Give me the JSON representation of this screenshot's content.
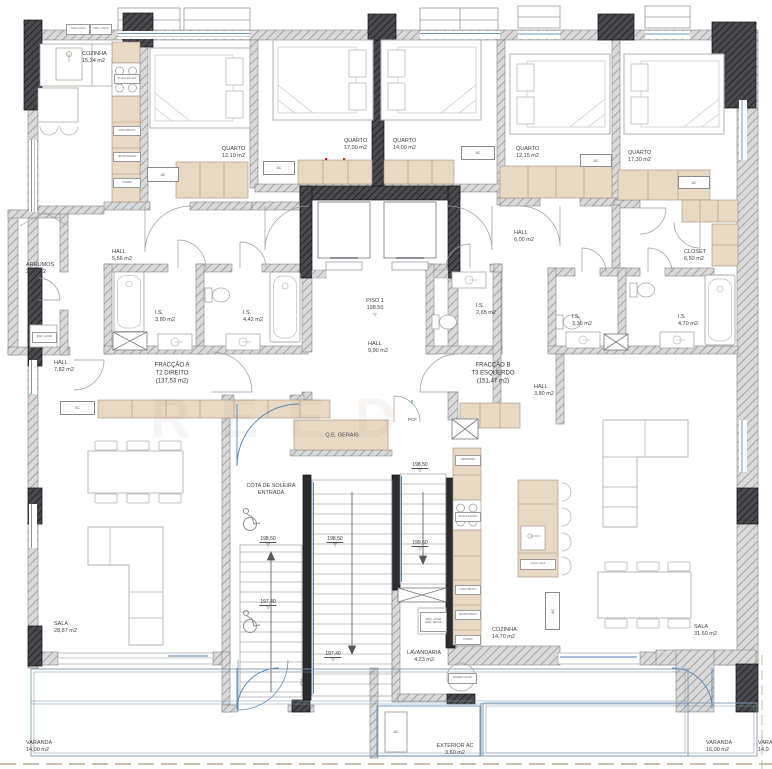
{
  "watermark": "REED",
  "ac_label": "AC",
  "colors": {
    "wall_fill": "#d9d9d9",
    "wall_line": "#8f8f94",
    "dark_fill": "#46464a",
    "tan": "#e8d9c4",
    "tan_border": "#a5937d",
    "blue": "#4f86b5",
    "furniture_line": "#b2b2ba",
    "text": "#3e3e47"
  },
  "rooms": {
    "cozinha_a": {
      "name": "COZINHA",
      "area": "15,34 m2"
    },
    "quarto_a1": {
      "name": "QUARTO",
      "area": "12,10 m2"
    },
    "quarto_a2": {
      "name": "QUARTO",
      "area": "17,00 m2"
    },
    "quarto_b1": {
      "name": "QUARTO",
      "area": "14,00 m2"
    },
    "quarto_b2": {
      "name": "QUARTO",
      "area": "12,15 m2"
    },
    "quarto_b3": {
      "name": "QUARTO",
      "area": "17,30 m2"
    },
    "hall_a1": {
      "name": "HALL",
      "area": "5,56 m2"
    },
    "arrumos": {
      "name": "ARRUMOS",
      "area": "2,00 m2"
    },
    "is_a1": {
      "name": "I.S.",
      "area": "3,60 m2"
    },
    "is_a2": {
      "name": "I.S.",
      "area": "4,42 m2"
    },
    "hall_a2": {
      "name": "HALL",
      "area": "7,82 m2"
    },
    "sala_a": {
      "name": "SALA",
      "area": "28,87 m2"
    },
    "varanda_a": {
      "name": "VARANDA",
      "area": "14,00 m2"
    },
    "hall_c": {
      "name": "HALL",
      "area": "9,90 m2"
    },
    "lavandaria": {
      "name": "LAVANDARIA",
      "area": "4,23 m2"
    },
    "exterior_ac": {
      "name": "EXTERIOR AC",
      "area": "3,60 m2"
    },
    "cozinha_b": {
      "name": "COZINHA",
      "area": "14,70 m2"
    },
    "sala_b": {
      "name": "SALA",
      "area": "31,60 m2"
    },
    "varanda_b": {
      "name": "VARANDA",
      "area": "16,00 m2"
    },
    "varanda_c": {
      "name": "VARANDA",
      "area": "14,0"
    },
    "hall_b1": {
      "name": "HALL",
      "area": "6,00 m2"
    },
    "closet": {
      "name": "CLOSET",
      "area": "6,50 m2"
    },
    "is_b1": {
      "name": "I.S.",
      "area": "2,65 m2"
    },
    "is_b2": {
      "name": "I.S.",
      "area": "3,30 m2"
    },
    "is_b3": {
      "name": "I.S.",
      "area": "4,70 m2"
    },
    "hall_b2": {
      "name": "HALL",
      "area": "3,80 m2"
    }
  },
  "fractions": {
    "a": {
      "line1": "FRACÇÃO A",
      "line2": "T2 DIREITO",
      "line3": "(137,53 m2)"
    },
    "b": {
      "line1": "FRACÇÃO B",
      "line2": "T3 ESQUERDO",
      "line3": "(151,47 m2)"
    }
  },
  "annotations": {
    "piso_name": "PISO 1",
    "piso_level": "198.50",
    "cota_line1": "COTA DE SOLEIRA",
    "cota_line2": "ENTRADA",
    "qe": "Q.E. GERAIS",
    "pcf": "PCF"
  },
  "levels": [
    {
      "value": "198,50"
    },
    {
      "value": "198,50"
    },
    {
      "value": "198,50"
    },
    {
      "value": "199,60"
    },
    {
      "value": "197,40"
    },
    {
      "value": "197,40"
    }
  ],
  "appliances": {
    "sink": "LAVA LOIÇA",
    "dishwasher": "MÁQ. LOIÇA",
    "pantry": "DESPENSA",
    "fridge": "FRIGORÍFICO",
    "micro": "MICROONDAS",
    "oven": "FORNO",
    "hob": "PLACA FOGÃO",
    "washer": "MÁQ. LAVAR",
    "dryer": "MÁQ. SECAR",
    "heatpump": "BOMBA CALOR"
  }
}
